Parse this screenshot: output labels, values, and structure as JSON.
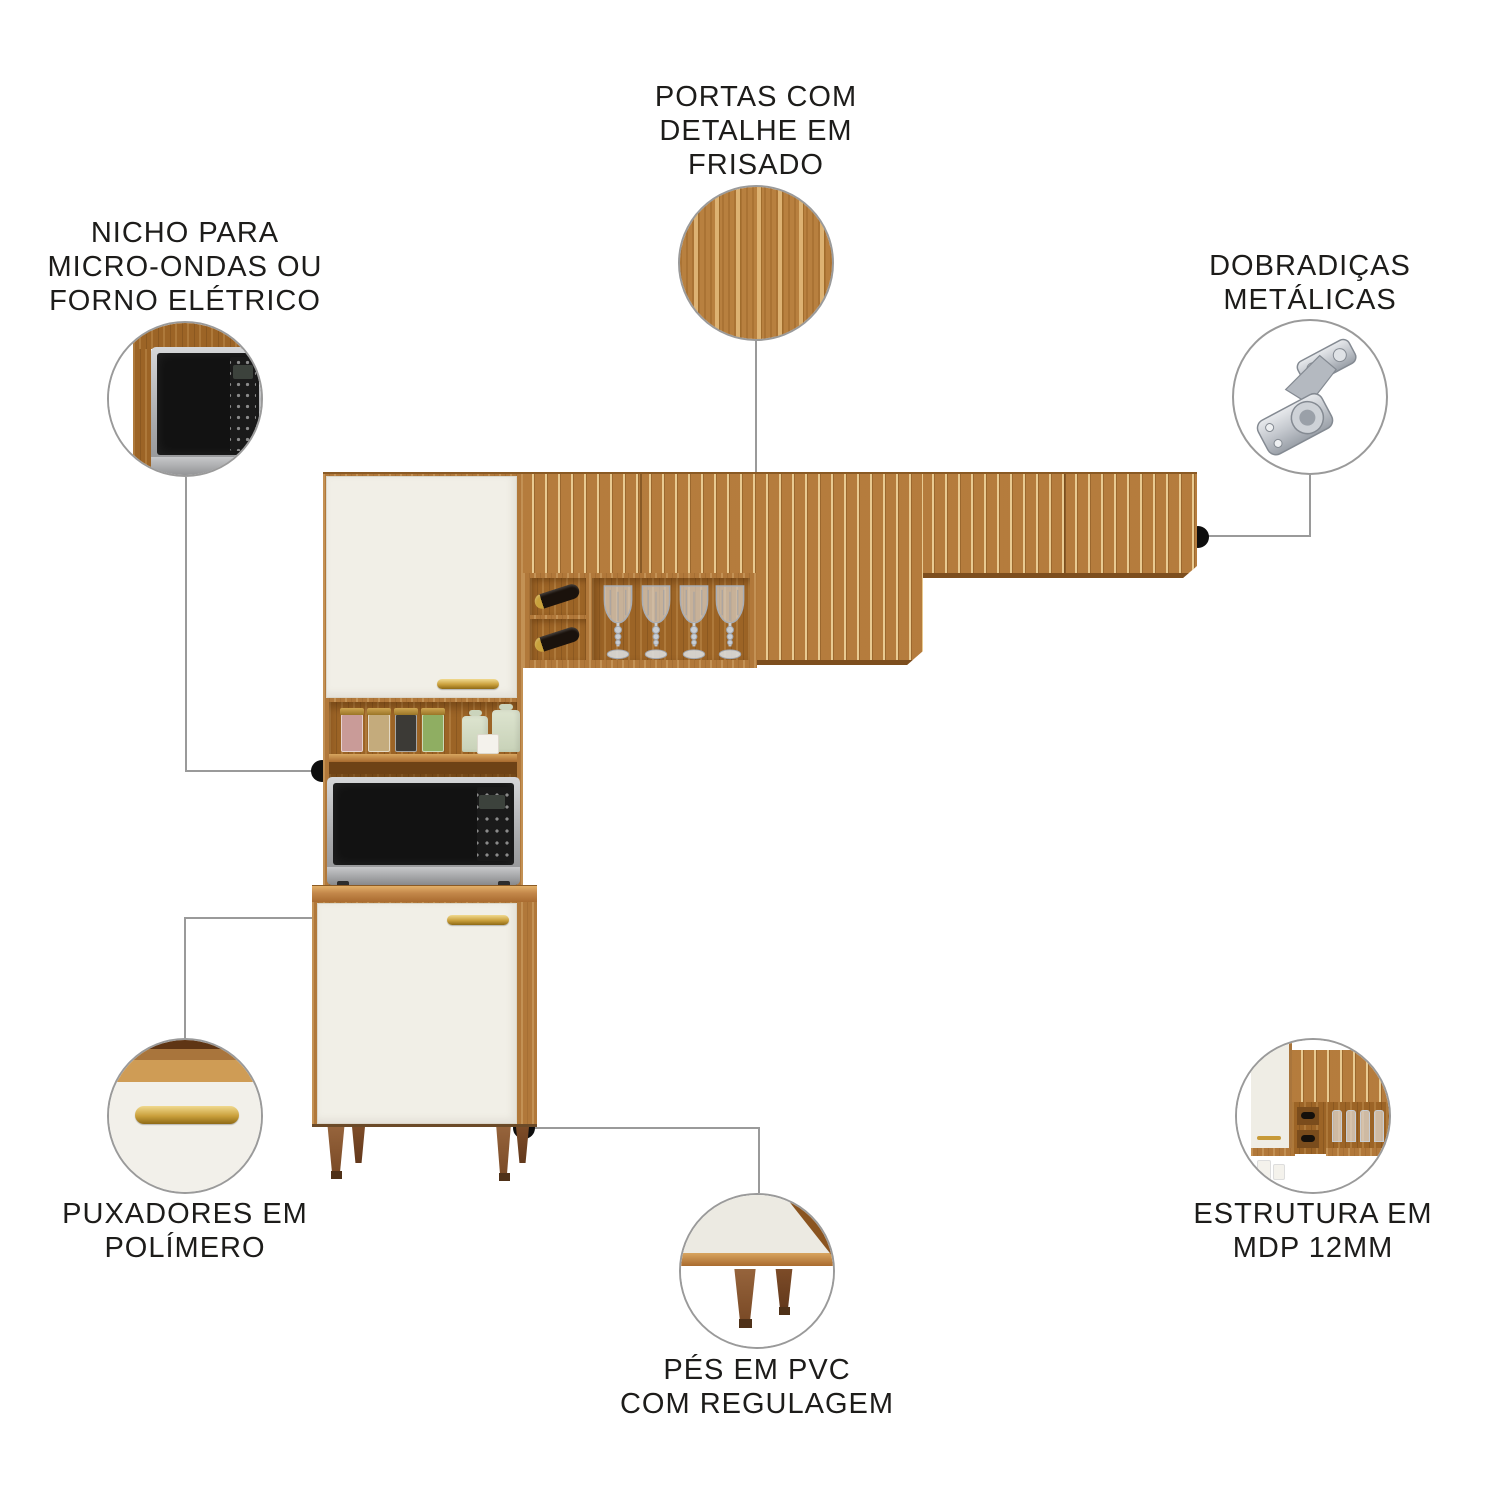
{
  "callouts": {
    "portas": {
      "lines": [
        "PORTAS COM",
        "DETALHE EM",
        "FRISADO"
      ]
    },
    "nicho": {
      "lines": [
        "NICHO PARA",
        "MICRO-ONDAS OU",
        "FORNO ELÉTRICO"
      ]
    },
    "dobradicas": {
      "lines": [
        "DOBRADIÇAS",
        "METÁLICAS"
      ]
    },
    "puxadores": {
      "lines": [
        "PUXADORES EM",
        "POLÍMERO"
      ]
    },
    "estrutura": {
      "lines": [
        "ESTRUTURA EM",
        "MDP 12MM"
      ]
    },
    "pes": {
      "lines": [
        "PÉS EM PVC",
        "COM REGULAGEM"
      ]
    }
  },
  "colors": {
    "wood": "#b57c3d",
    "wood_light": "#e0b97f",
    "wood_dark": "#7d4e1e",
    "door_white": "#f1efe7",
    "handle_gold": "#c79a38",
    "text": "#1d1c1a",
    "leader_line": "#9a9a9a",
    "marker_dot": "#0e0e0e",
    "metal_silver": "#c9ccd1",
    "microwave_black": "#121212"
  },
  "icons": {
    "portas_detail": "fluted-wood-texture",
    "nicho_detail": "microwave-in-niche",
    "dobradicas_detail": "metal-hinge",
    "puxadores_detail": "gold-handle-on-door",
    "estrutura_detail": "cabinet-corner-structure",
    "pes_detail": "pvc-adjustable-feet"
  }
}
